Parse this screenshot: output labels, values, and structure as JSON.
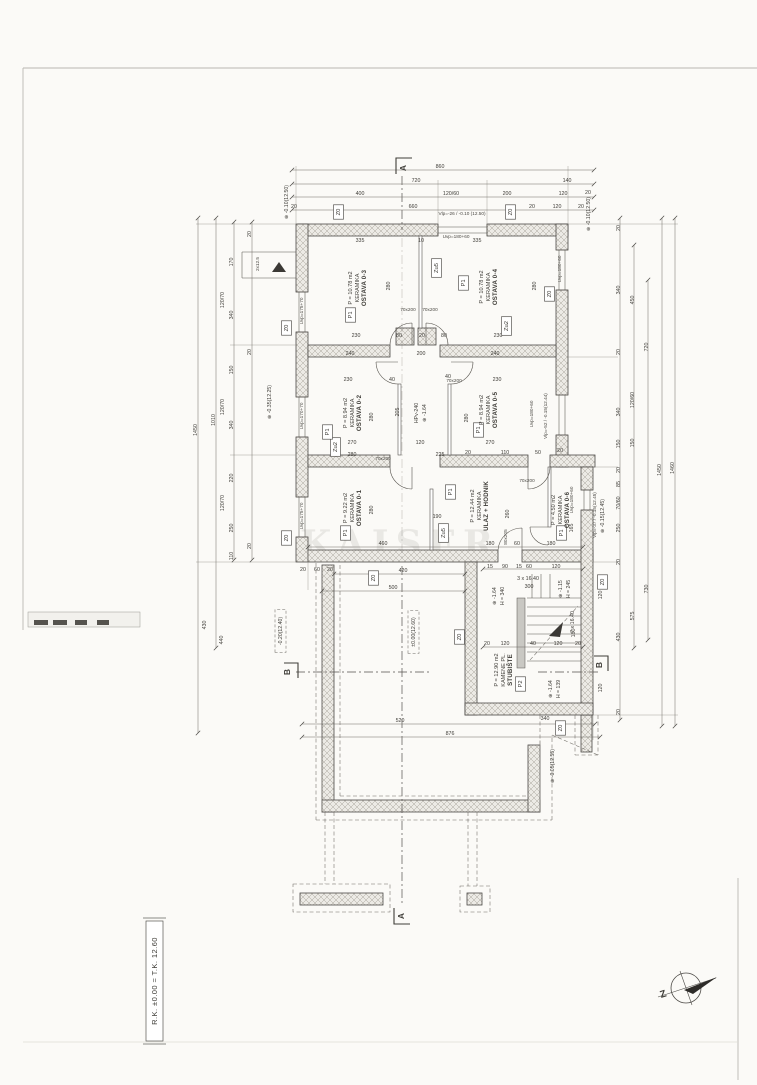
{
  "title_block": {
    "text": "R.K. ±0.00 = T.K. 12.60"
  },
  "watermark": "KAISER",
  "compass": {
    "letter": "Z"
  },
  "sections": {
    "a": "A",
    "b": "B"
  },
  "colors": {
    "paper": "#fbfaf7",
    "line": "#4b4945",
    "hatch": "#eceae5",
    "text": "#3f3d38"
  },
  "rooms": [
    {
      "name": "OSTAVA 0-3",
      "finish": "KERAMIKA",
      "area": "P = 10.78 m2",
      "tag": "P1",
      "x": 352,
      "y": 288
    },
    {
      "name": "OSTAVA 0-4",
      "finish": "KERAMIKA",
      "area": "P = 10.78 m2",
      "tag": "P1",
      "x": 483,
      "y": 287
    },
    {
      "name": "OSTAVA 0-2",
      "finish": "KERAMIKA",
      "area": "P = 8.94 m2",
      "tag": "P1",
      "x": 347,
      "y": 413
    },
    {
      "name": "OSTAVA 0-5",
      "finish": "KERAMIKA",
      "area": "P = 8.94 m2",
      "tag": "P1",
      "x": 483,
      "y": 410
    },
    {
      "name": "OSTAVA 0-1",
      "finish": "KERAMIKA",
      "area": "P = 9.22 m2",
      "tag": "P1",
      "x": 347,
      "y": 508
    },
    {
      "name": "ULAZ + HODNIK",
      "finish": "KERAMIKA",
      "area": "P = 12.44 m2",
      "tag": "P1",
      "x": 474,
      "y": 506
    },
    {
      "name": "OSTAVA 0-6",
      "finish": "KERAMIKA",
      "area": "P = 4.50 m2",
      "tag": "P1",
      "x": 555,
      "y": 510
    },
    {
      "name": "STUBIŠTE",
      "finish": "KAMENE PL.",
      "area": "P = 12.90 m2",
      "tag": "P2",
      "x": 498,
      "y": 670
    }
  ],
  "tags": [
    {
      "t": "Z0",
      "x": 340,
      "y": 212
    },
    {
      "t": "Z0",
      "x": 512,
      "y": 212
    },
    {
      "t": "Z0",
      "x": 288,
      "y": 328
    },
    {
      "t": "Z0",
      "x": 288,
      "y": 538
    },
    {
      "t": "Z0",
      "x": 551,
      "y": 294
    },
    {
      "t": "Zu5",
      "x": 438,
      "y": 268
    },
    {
      "t": "Zu2",
      "x": 508,
      "y": 326
    },
    {
      "t": "Zu2",
      "x": 337,
      "y": 447
    },
    {
      "t": "Zu5",
      "x": 445,
      "y": 533
    },
    {
      "t": "Z0",
      "x": 461,
      "y": 637
    },
    {
      "t": "Z0",
      "x": 604,
      "y": 582
    },
    {
      "t": "Z0",
      "x": 375,
      "y": 578
    },
    {
      "t": "Z0",
      "x": 562,
      "y": 728
    },
    {
      "t": "P1",
      "x": 352,
      "y": 315
    },
    {
      "t": "P1",
      "x": 465,
      "y": 283
    },
    {
      "t": "P1",
      "x": 329,
      "y": 432
    },
    {
      "t": "P1",
      "x": 480,
      "y": 430
    },
    {
      "t": "P1",
      "x": 347,
      "y": 533
    },
    {
      "t": "P1",
      "x": 452,
      "y": 492
    },
    {
      "t": "P1",
      "x": 563,
      "y": 533
    },
    {
      "t": "P2",
      "x": 522,
      "y": 684
    }
  ],
  "levels": [
    {
      "t": "⊕ -0.10(12.50)",
      "x": 288,
      "y": 202
    },
    {
      "t": "⊕ -0.10(12.50)",
      "x": 590,
      "y": 214
    },
    {
      "t": "⊕ -0.35(12.25)",
      "x": 271,
      "y": 402
    },
    {
      "t": "⊕ -0.15(12.45)",
      "x": 604,
      "y": 516
    },
    {
      "t": "-0.20(12.40)",
      "x": 282,
      "y": 631,
      "boxed": true
    },
    {
      "t": "±0.00(12.60)",
      "x": 415,
      "y": 632,
      "boxed": true
    },
    {
      "t": "⊕ -0.05(12.55)",
      "x": 554,
      "y": 766
    },
    {
      "t": "⊕ -1.64",
      "x": 426,
      "y": 413
    },
    {
      "t": "HPv-240",
      "x": 418,
      "y": 413
    },
    {
      "t": "⊕ -1.64",
      "x": 496,
      "y": 596
    },
    {
      "t": "H = 340",
      "x": 504,
      "y": 596
    },
    {
      "t": "⊕ -1.15",
      "x": 562,
      "y": 589
    },
    {
      "t": "H = 245",
      "x": 570,
      "y": 589
    },
    {
      "t": "⊕ -1.64",
      "x": 552,
      "y": 689
    },
    {
      "t": "H = 139",
      "x": 560,
      "y": 689
    }
  ],
  "annotations": [
    {
      "t": "Vlp=-26 / -0.10 (12.50)",
      "x": 462,
      "y": 215,
      "r": 0
    },
    {
      "t": "Uvp=180+60",
      "x": 456,
      "y": 238,
      "r": 0
    },
    {
      "t": "Uvp=175+70",
      "x": 303,
      "y": 311
    },
    {
      "t": "Uvp=170+70",
      "x": 303,
      "y": 416
    },
    {
      "t": "Uvp=175+70",
      "x": 303,
      "y": 516
    },
    {
      "t": "Uvp=180+60",
      "x": 561,
      "y": 269
    },
    {
      "t": "Uvp=180+60",
      "x": 533,
      "y": 414
    },
    {
      "t": "Vlp=-52 / -0.15(12.44)",
      "x": 547,
      "y": 416
    },
    {
      "t": "Uvp=180+60",
      "x": 573,
      "y": 500
    },
    {
      "t": "Vlp=-37 / -0.15(12.45)",
      "x": 596,
      "y": 515
    },
    {
      "t": "2x12.5",
      "x": 259,
      "y": 264
    },
    {
      "t": "70x200",
      "x": 408,
      "y": 311,
      "r": 0
    },
    {
      "t": "70x200",
      "x": 430,
      "y": 311,
      "r": 0
    },
    {
      "t": "70x200",
      "x": 454,
      "y": 382,
      "r": 0
    },
    {
      "t": "70x200",
      "x": 383,
      "y": 460,
      "r": 0
    },
    {
      "t": "70x200",
      "x": 527,
      "y": 482,
      "r": 0
    },
    {
      "t": "80x205",
      "x": 507,
      "y": 537
    }
  ],
  "dimensions": [
    {
      "t": "860",
      "x": 440,
      "y": 168,
      "r": 0
    },
    {
      "t": "720",
      "x": 416,
      "y": 182,
      "r": 0
    },
    {
      "t": "140",
      "x": 567,
      "y": 182,
      "r": 0
    },
    {
      "t": "400",
      "x": 360,
      "y": 195,
      "r": 0
    },
    {
      "t": "120/60",
      "x": 451,
      "y": 195,
      "r": 0
    },
    {
      "t": "200",
      "x": 507,
      "y": 195,
      "r": 0
    },
    {
      "t": "120",
      "x": 563,
      "y": 195,
      "r": 0
    },
    {
      "t": "20",
      "x": 588,
      "y": 194,
      "r": 0
    },
    {
      "t": "20",
      "x": 294,
      "y": 208,
      "r": 0
    },
    {
      "t": "660",
      "x": 413,
      "y": 208,
      "r": 0
    },
    {
      "t": "20",
      "x": 532,
      "y": 208,
      "r": 0
    },
    {
      "t": "120",
      "x": 557,
      "y": 208,
      "r": 0
    },
    {
      "t": "20",
      "x": 581,
      "y": 208,
      "r": 0
    },
    {
      "t": "335",
      "x": 360,
      "y": 242,
      "r": 0
    },
    {
      "t": "10",
      "x": 421,
      "y": 242,
      "r": 0
    },
    {
      "t": "335",
      "x": 477,
      "y": 242,
      "r": 0
    },
    {
      "t": "230",
      "x": 356,
      "y": 337,
      "r": 0
    },
    {
      "t": "80",
      "x": 399,
      "y": 337,
      "r": 0
    },
    {
      "t": "20",
      "x": 422,
      "y": 337,
      "r": 0
    },
    {
      "t": "80",
      "x": 444,
      "y": 337,
      "r": 0
    },
    {
      "t": "230",
      "x": 498,
      "y": 337,
      "r": 0
    },
    {
      "t": "240",
      "x": 350,
      "y": 355,
      "r": 0
    },
    {
      "t": "200",
      "x": 421,
      "y": 355,
      "r": 0
    },
    {
      "t": "240",
      "x": 495,
      "y": 355,
      "r": 0
    },
    {
      "t": "230",
      "x": 348,
      "y": 381,
      "r": 0
    },
    {
      "t": "40",
      "x": 392,
      "y": 381,
      "r": 0
    },
    {
      "t": "40",
      "x": 448,
      "y": 378,
      "r": 0
    },
    {
      "t": "230",
      "x": 497,
      "y": 381,
      "r": 0
    },
    {
      "t": "270",
      "x": 352,
      "y": 444,
      "r": 0
    },
    {
      "t": "120",
      "x": 420,
      "y": 444,
      "r": 0
    },
    {
      "t": "270",
      "x": 490,
      "y": 444,
      "r": 0
    },
    {
      "t": "280",
      "x": 352,
      "y": 456,
      "r": 0
    },
    {
      "t": "225",
      "x": 440,
      "y": 456,
      "r": 0
    },
    {
      "t": "20",
      "x": 468,
      "y": 454,
      "r": 0
    },
    {
      "t": "110",
      "x": 505,
      "y": 454,
      "r": 0
    },
    {
      "t": "50",
      "x": 538,
      "y": 454,
      "r": 0
    },
    {
      "t": "20",
      "x": 560,
      "y": 452,
      "r": 0
    },
    {
      "t": "190",
      "x": 437,
      "y": 518,
      "r": 0
    },
    {
      "t": "280",
      "x": 390,
      "y": 286
    },
    {
      "t": "280",
      "x": 536,
      "y": 286
    },
    {
      "t": "280",
      "x": 373,
      "y": 417
    },
    {
      "t": "205",
      "x": 399,
      "y": 412
    },
    {
      "t": "280",
      "x": 468,
      "y": 418
    },
    {
      "t": "280",
      "x": 373,
      "y": 510
    },
    {
      "t": "260",
      "x": 509,
      "y": 514
    },
    {
      "t": "165",
      "x": 573,
      "y": 528
    },
    {
      "t": "1450",
      "x": 197,
      "y": 430
    },
    {
      "t": "1010",
      "x": 215,
      "y": 420
    },
    {
      "t": "170",
      "x": 233,
      "y": 262
    },
    {
      "t": "340",
      "x": 233,
      "y": 315
    },
    {
      "t": "150",
      "x": 233,
      "y": 370
    },
    {
      "t": "340",
      "x": 233,
      "y": 425
    },
    {
      "t": "220",
      "x": 233,
      "y": 478
    },
    {
      "t": "250",
      "x": 233,
      "y": 528
    },
    {
      "t": "110",
      "x": 233,
      "y": 556
    },
    {
      "t": "120/70",
      "x": 224,
      "y": 300
    },
    {
      "t": "120/70",
      "x": 224,
      "y": 407
    },
    {
      "t": "120/70",
      "x": 224,
      "y": 503
    },
    {
      "t": "20",
      "x": 251,
      "y": 234
    },
    {
      "t": "20",
      "x": 251,
      "y": 352
    },
    {
      "t": "20",
      "x": 251,
      "y": 546
    },
    {
      "t": "430",
      "x": 206,
      "y": 625
    },
    {
      "t": "440",
      "x": 223,
      "y": 640
    },
    {
      "t": "20",
      "x": 620,
      "y": 228
    },
    {
      "t": "340",
      "x": 620,
      "y": 290
    },
    {
      "t": "20",
      "x": 620,
      "y": 352
    },
    {
      "t": "340",
      "x": 620,
      "y": 412
    },
    {
      "t": "150",
      "x": 620,
      "y": 444
    },
    {
      "t": "20",
      "x": 620,
      "y": 470
    },
    {
      "t": "85",
      "x": 620,
      "y": 484
    },
    {
      "t": "70/60",
      "x": 620,
      "y": 503
    },
    {
      "t": "250",
      "x": 620,
      "y": 528
    },
    {
      "t": "20",
      "x": 620,
      "y": 562
    },
    {
      "t": "430",
      "x": 620,
      "y": 637
    },
    {
      "t": "20",
      "x": 620,
      "y": 712
    },
    {
      "t": "450",
      "x": 634,
      "y": 300
    },
    {
      "t": "120/60",
      "x": 634,
      "y": 400
    },
    {
      "t": "150",
      "x": 634,
      "y": 443
    },
    {
      "t": "575",
      "x": 634,
      "y": 616
    },
    {
      "t": "720",
      "x": 648,
      "y": 347
    },
    {
      "t": "730",
      "x": 648,
      "y": 589
    },
    {
      "t": "1450",
      "x": 661,
      "y": 470
    },
    {
      "t": "1460",
      "x": 674,
      "y": 468
    },
    {
      "t": "20",
      "x": 303,
      "y": 571,
      "r": 0
    },
    {
      "t": "60",
      "x": 317,
      "y": 571,
      "r": 0
    },
    {
      "t": "20",
      "x": 330,
      "y": 571,
      "r": 0
    },
    {
      "t": "420",
      "x": 403,
      "y": 572,
      "r": 0
    },
    {
      "t": "500",
      "x": 393,
      "y": 589,
      "r": 0
    },
    {
      "t": "460",
      "x": 383,
      "y": 545,
      "r": 0
    },
    {
      "t": "180",
      "x": 490,
      "y": 545,
      "r": 0
    },
    {
      "t": "60",
      "x": 517,
      "y": 545,
      "r": 0
    },
    {
      "t": "180",
      "x": 551,
      "y": 545,
      "r": 0
    },
    {
      "t": "520",
      "x": 400,
      "y": 722,
      "r": 0
    },
    {
      "t": "340",
      "x": 545,
      "y": 720,
      "r": 0
    },
    {
      "t": "876",
      "x": 450,
      "y": 735,
      "r": 0
    },
    {
      "t": "15",
      "x": 490,
      "y": 568,
      "r": 0
    },
    {
      "t": "90",
      "x": 505,
      "y": 568,
      "r": 0
    },
    {
      "t": "15",
      "x": 519,
      "y": 568,
      "r": 0
    },
    {
      "t": "60",
      "x": 529,
      "y": 568,
      "r": 0
    },
    {
      "t": "120",
      "x": 556,
      "y": 568,
      "r": 0
    },
    {
      "t": "3 x 16.40",
      "x": 528,
      "y": 580,
      "r": 0
    },
    {
      "t": "300",
      "x": 529,
      "y": 588,
      "r": 0
    },
    {
      "t": "7 x 16.40",
      "x": 574,
      "y": 622
    },
    {
      "t": "180",
      "x": 575,
      "y": 633
    },
    {
      "t": "120",
      "x": 602,
      "y": 595
    },
    {
      "t": "120",
      "x": 602,
      "y": 688
    },
    {
      "t": "20",
      "x": 487,
      "y": 645,
      "r": 0
    },
    {
      "t": "120",
      "x": 505,
      "y": 645,
      "r": 0
    },
    {
      "t": "40",
      "x": 533,
      "y": 645,
      "r": 0
    },
    {
      "t": "120",
      "x": 558,
      "y": 645,
      "r": 0
    },
    {
      "t": "20",
      "x": 578,
      "y": 645,
      "r": 0
    }
  ]
}
